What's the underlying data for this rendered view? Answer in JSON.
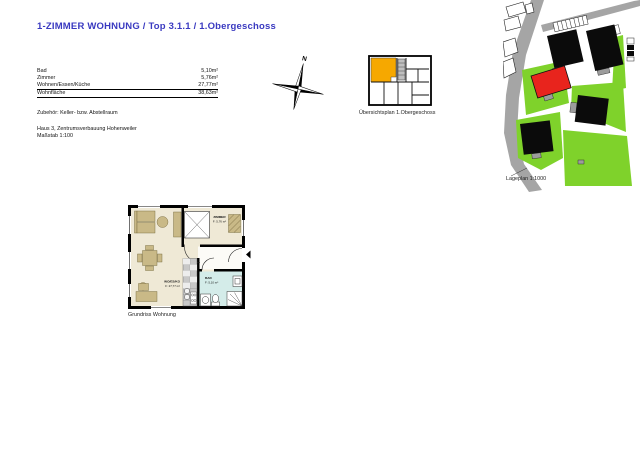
{
  "page": {
    "title": "1-ZIMMER WOHNUNG / Top 3.1.1 / 1.Obergeschoss",
    "title_color": "#3939C0"
  },
  "area_table": {
    "rows": [
      {
        "label": "Bad",
        "value": "5,10m²"
      },
      {
        "label": "Zimmer",
        "value": "5,76m²"
      },
      {
        "label": "Wohnen/Essen/Küche",
        "value": "27,77m²"
      },
      {
        "label": "Wohnfläche",
        "value": "38,63m²"
      }
    ]
  },
  "notes": {
    "accessories": "Zubehör: Keller- bzw. Abstellraum",
    "project": "Haus 3, Zentrumsverbauung Hohenweiler",
    "scale": "Maßstab 1:100"
  },
  "compass": {
    "north_label": "N"
  },
  "overview_plan": {
    "caption": "Übersichtsplan 1.Obergeschoss",
    "highlight_color": "#F6A800"
  },
  "site_plan": {
    "caption": "Lageplan 1:1000",
    "colors": {
      "lawn": "#7FD22B",
      "highlight_building": "#E8241D",
      "building": "#0B0B0B",
      "road": "#A5A5A5"
    }
  },
  "floor_plan": {
    "caption": "Grundriss Wohnung",
    "rooms": {
      "zimmer": {
        "name": "ZIMMER",
        "area": "F: 5,76 m²"
      },
      "wohnen": {
        "name": "WO/ES/KO",
        "area": "F: 27,77 m²"
      },
      "bad": {
        "name": "BAD",
        "area": "F: 5,10 m²"
      }
    },
    "colors": {
      "floor": "#EFE9D6",
      "furniture": "#C9B987",
      "bath_floor": "#D4ECE9",
      "hall_floor": "#FCFBF7"
    }
  }
}
